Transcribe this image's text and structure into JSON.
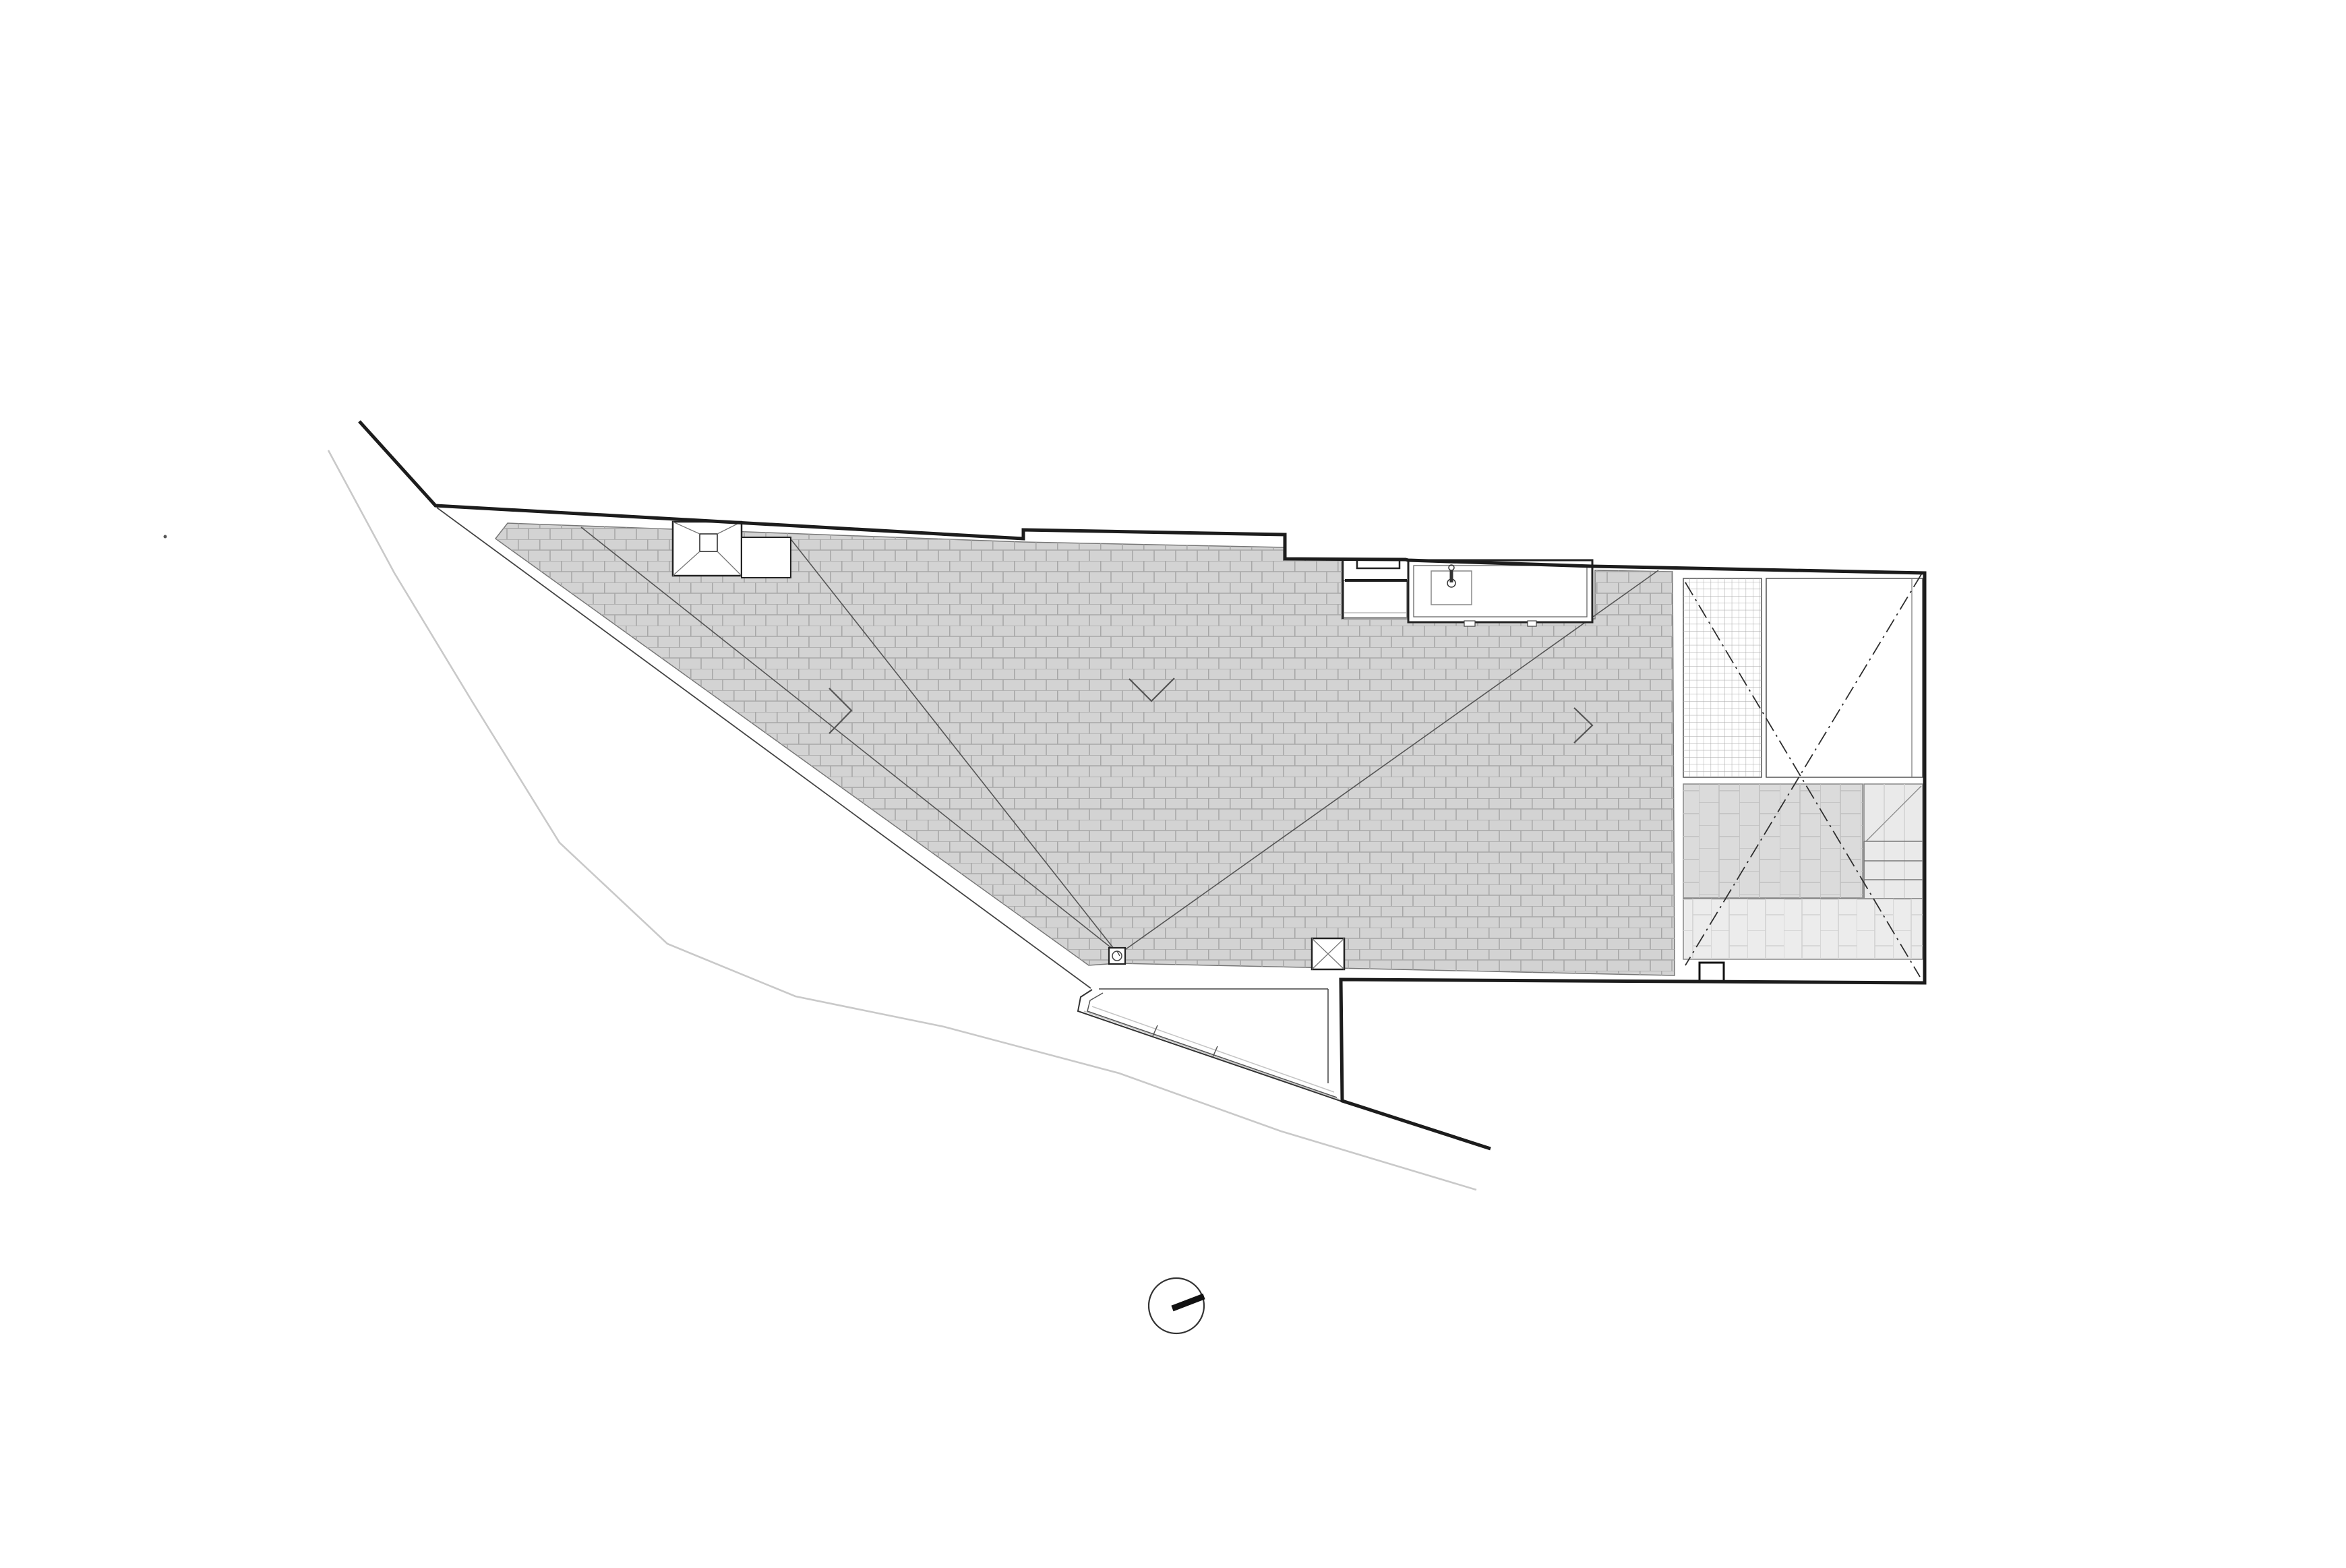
{
  "document": {
    "title": "Architectural roof plan",
    "type": "architectural-roof-plan",
    "visible_text": [],
    "notes": "Line drawing only; no text labels, dimensions or annotations are visible on the sheet"
  },
  "colors": {
    "paper": "#ffffff",
    "boundary_dark": "#1c1c1c",
    "line_dark2": "#222222",
    "line_medium": "#444444",
    "line_valley": "#555555",
    "line_thin": "#777777",
    "line_faint": "#c9c9c9",
    "wall_light": "#c4c4c4",
    "roof_fill": "#d3d3d3",
    "roof_joint": "#a8a8a8",
    "band_a_fill": "#dbdbdb",
    "band_a_joint": "#c0c0c0",
    "band_b_fill": "#ececec",
    "band_b_joint": "#d2d2d2",
    "stair_fill": "#eaeaea",
    "grid_line": "#a6a6a6",
    "dashdot": "#2e2e2e"
  },
  "elements": [
    {
      "name": "site-boundary",
      "description": "thick black property/building boundary line"
    },
    {
      "name": "lot-line",
      "description": "thin parallel inner site line"
    },
    {
      "name": "kerb-line",
      "description": "faint grey street kerb curve"
    },
    {
      "name": "main-roof",
      "description": "large grey tiled roof plane, running-bond tile hatch"
    },
    {
      "name": "pyramid-rooflight",
      "description": "square rooflight with hipped glazing"
    },
    {
      "name": "rooflight-curb",
      "description": "white curb beside pyramid rooflight"
    },
    {
      "name": "roof-counter-sink",
      "description": "built-in worktop with sink and tap"
    },
    {
      "name": "planter-niche",
      "description": "recessed white niche left of the counter"
    },
    {
      "name": "valley-lines",
      "description": "roof valley fold lines meeting at drain"
    },
    {
      "name": "slope-arrows",
      "description": "chevron slope-direction marks"
    },
    {
      "name": "roof-drain",
      "description": "outlet box with round gully"
    },
    {
      "name": "access-hatch",
      "description": "small square hatch with X"
    },
    {
      "name": "glass-grid-roof",
      "description": "fine square-grid glazed strip"
    },
    {
      "name": "void-dashed-x",
      "description": "dash-dot X over terrace void"
    },
    {
      "name": "seam-roof-band",
      "description": "standing-seam tile band"
    },
    {
      "name": "roof-stair",
      "description": "short external stair flight"
    },
    {
      "name": "lower-tile-band",
      "description": "lower light tile band"
    },
    {
      "name": "chimney-box",
      "description": "small square box on lower edge"
    },
    {
      "name": "entrance-court",
      "description": "lower entrance courtyard with retaining wall"
    },
    {
      "name": "north-indicator",
      "description": "circle with needle pointing east-north-east"
    }
  ],
  "north_indicator": {
    "bearing": "ENE"
  }
}
